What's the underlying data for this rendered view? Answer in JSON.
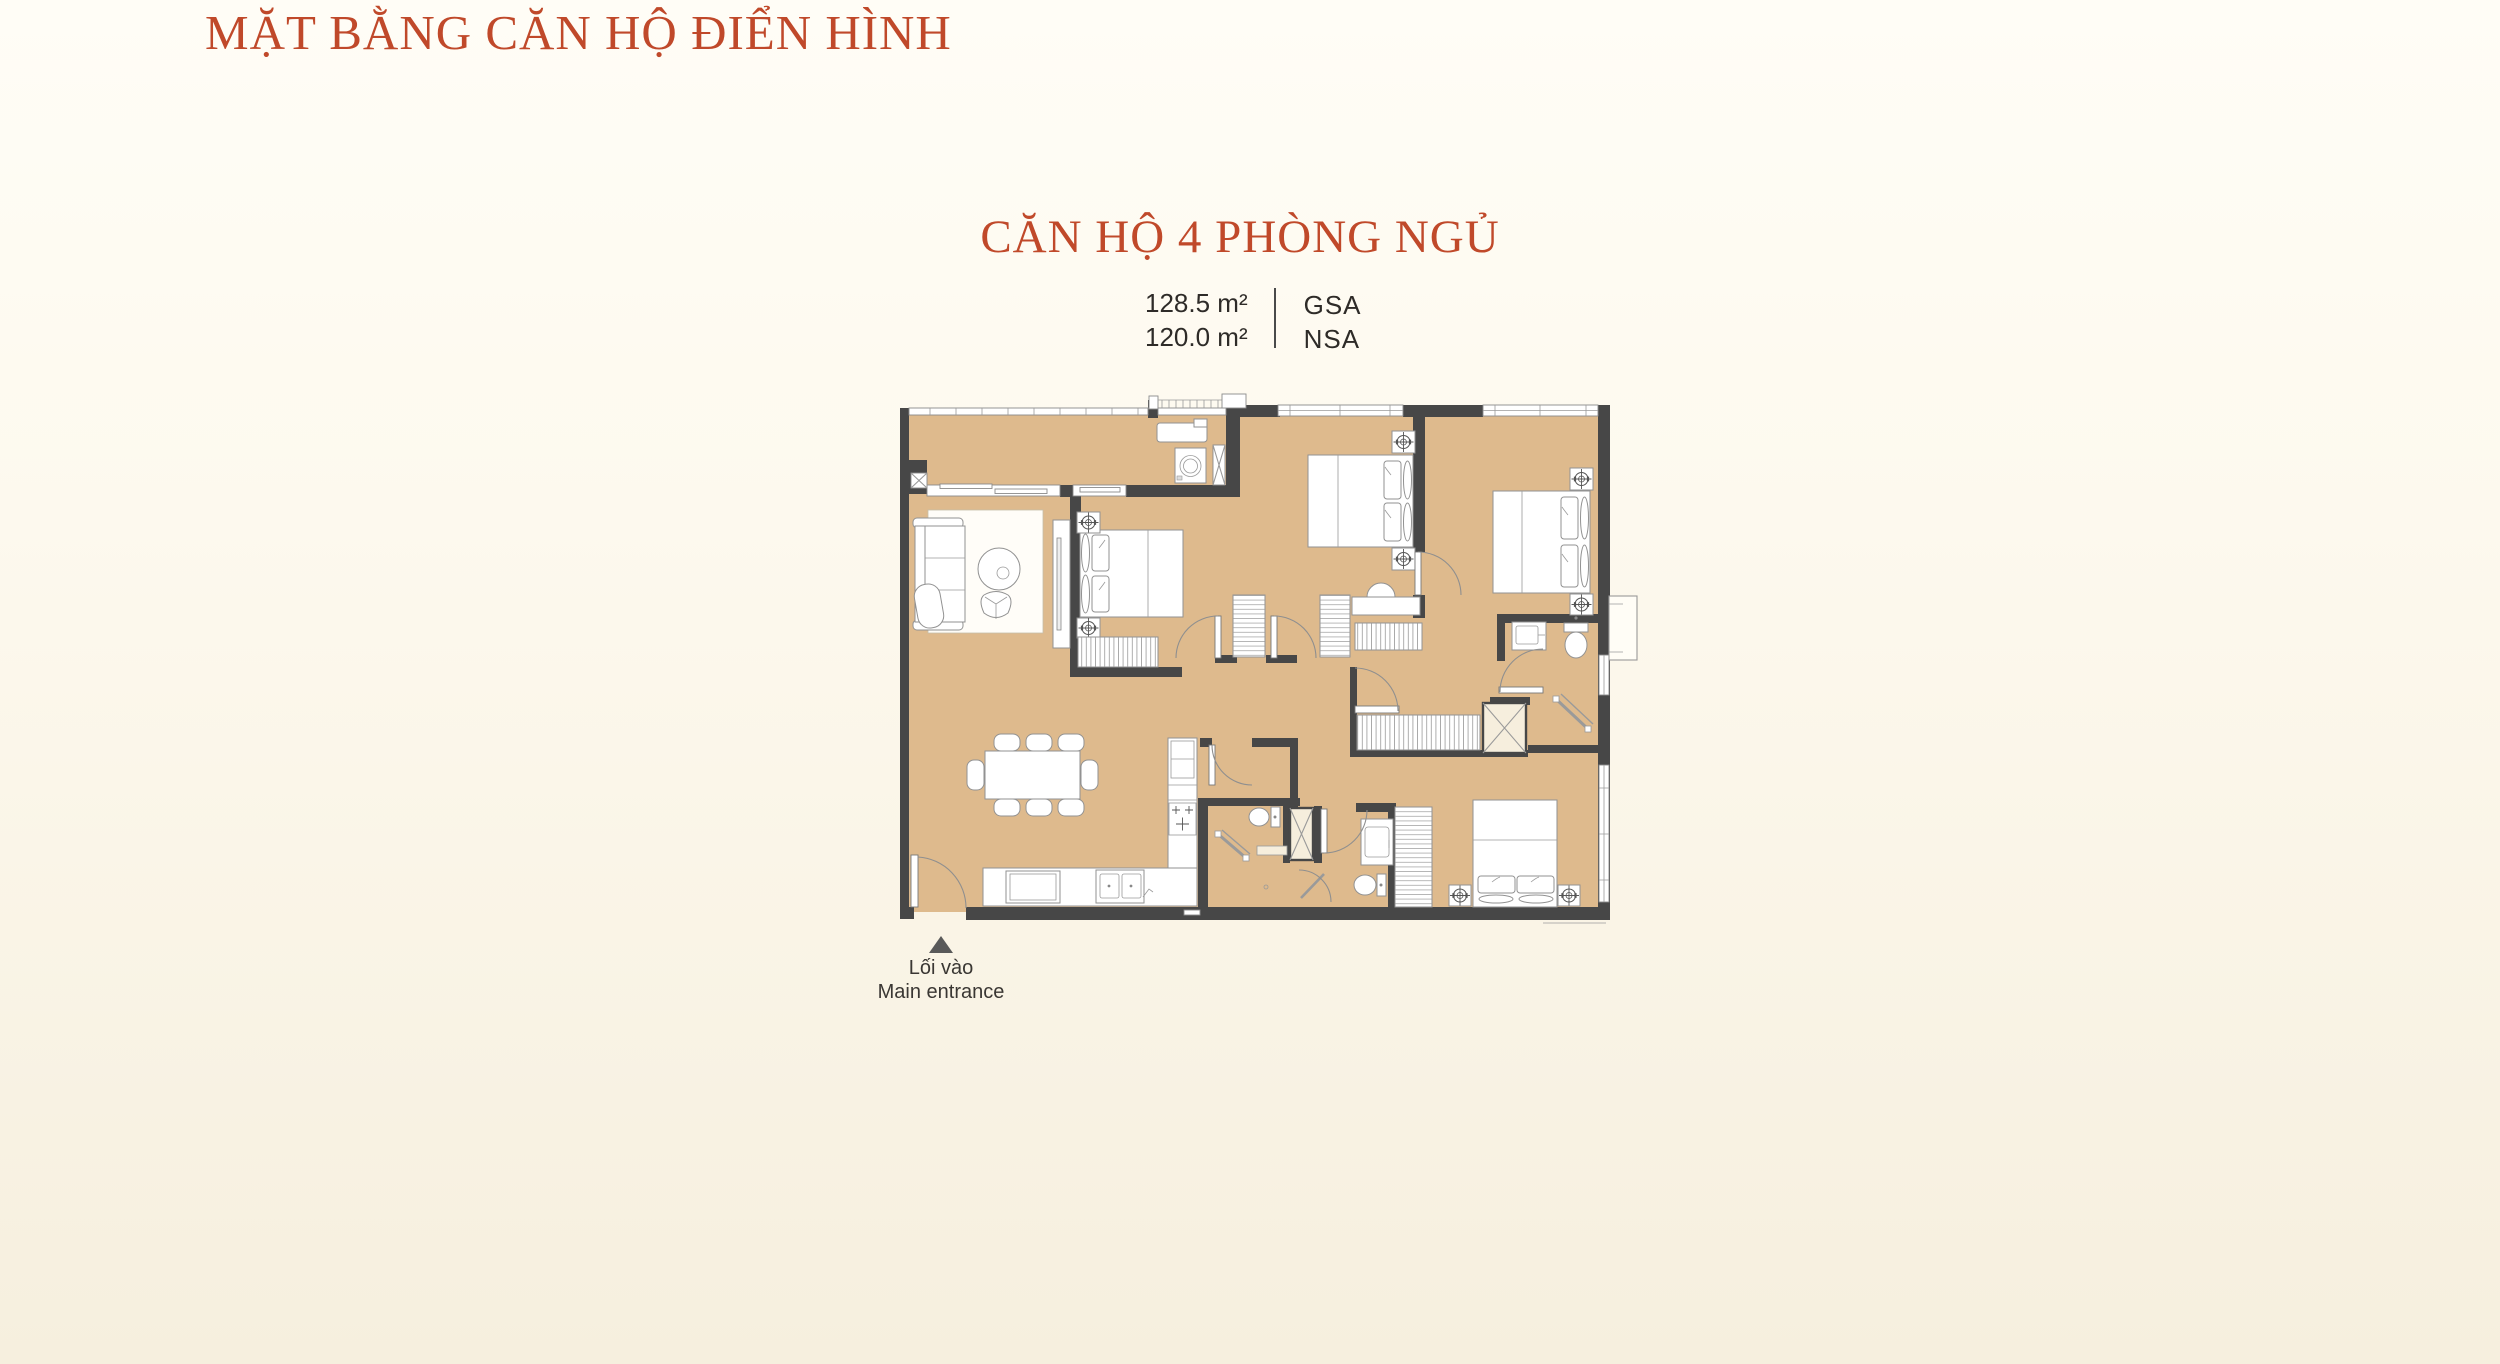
{
  "page": {
    "title": "MẶT BẰNG CĂN HỘ ĐIỂN HÌNH"
  },
  "unit": {
    "name": "CĂN HỘ 4 PHÒNG NGỦ",
    "areas": [
      {
        "value": "128.5 m²",
        "label": "GSA"
      },
      {
        "value": "120.0 m²",
        "label": "NSA"
      }
    ]
  },
  "floorplan": {
    "type": "apartment-floor-plan",
    "bedrooms_shown": 4,
    "floor_color": "#deba8d",
    "wall_color": "#474747"
  },
  "entrance": {
    "label_vi": "Lối vào",
    "label_en": "Main entrance",
    "marker": "up-triangle"
  },
  "colors": {
    "accent": "#c0492a",
    "text": "#2e2b28"
  }
}
